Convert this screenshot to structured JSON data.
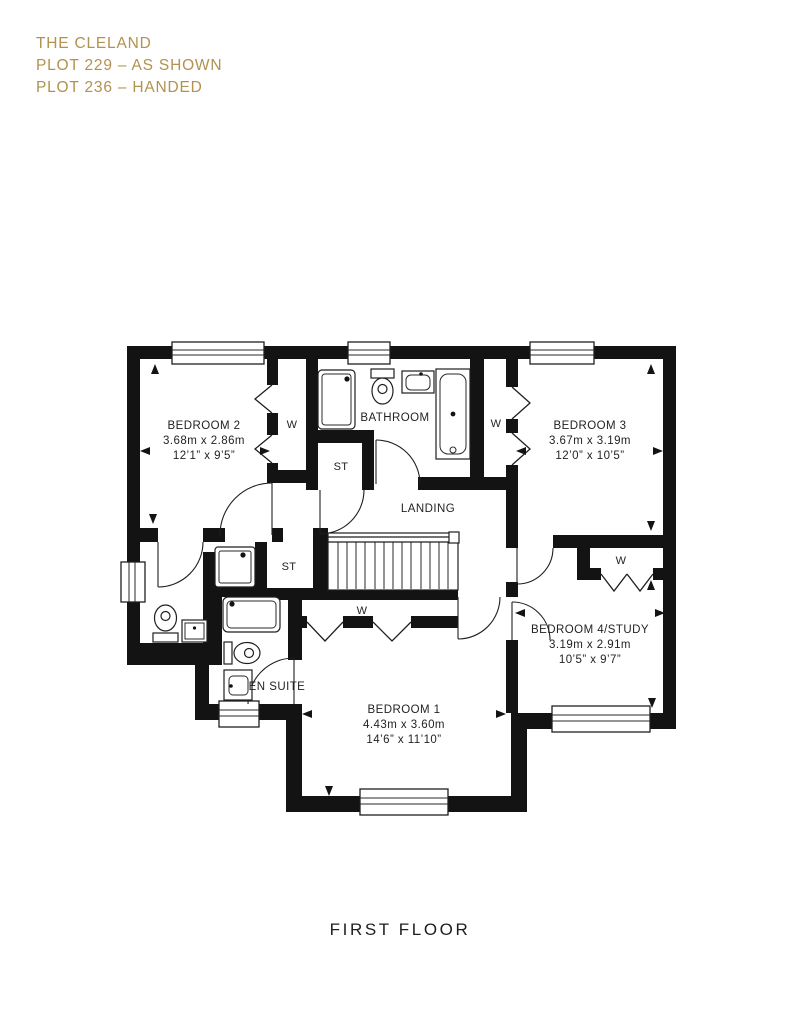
{
  "header": {
    "title": "THE CLELAND",
    "plot1": "PLOT 229 – AS SHOWN",
    "plot2": "PLOT 236 – HANDED"
  },
  "floor": {
    "label": "FIRST FLOOR"
  },
  "rooms": {
    "bedroom2": {
      "name": "BEDROOM 2",
      "metric": "3.68m x 2.86m",
      "imperial": "12’1” x 9’5”"
    },
    "bedroom3": {
      "name": "BEDROOM 3",
      "metric": "3.67m x 3.19m",
      "imperial": "12’0” x 10’5”"
    },
    "bedroom4": {
      "name": "BEDROOM 4/STUDY",
      "metric": "3.19m x 2.91m",
      "imperial": "10’5” x 9’7”"
    },
    "bedroom1": {
      "name": "BEDROOM 1",
      "metric": "4.43m x 3.60m",
      "imperial": "14’6” x 11’10”"
    },
    "bathroom": {
      "name": "BATHROOM"
    },
    "landing": {
      "name": "LANDING"
    },
    "ensuite": {
      "name": "EN SUITE"
    }
  },
  "tags": {
    "wardrobe": "W",
    "store": "ST"
  },
  "colors": {
    "accent": "#B3914E",
    "ink": "#231F20",
    "wall": "#131313"
  }
}
